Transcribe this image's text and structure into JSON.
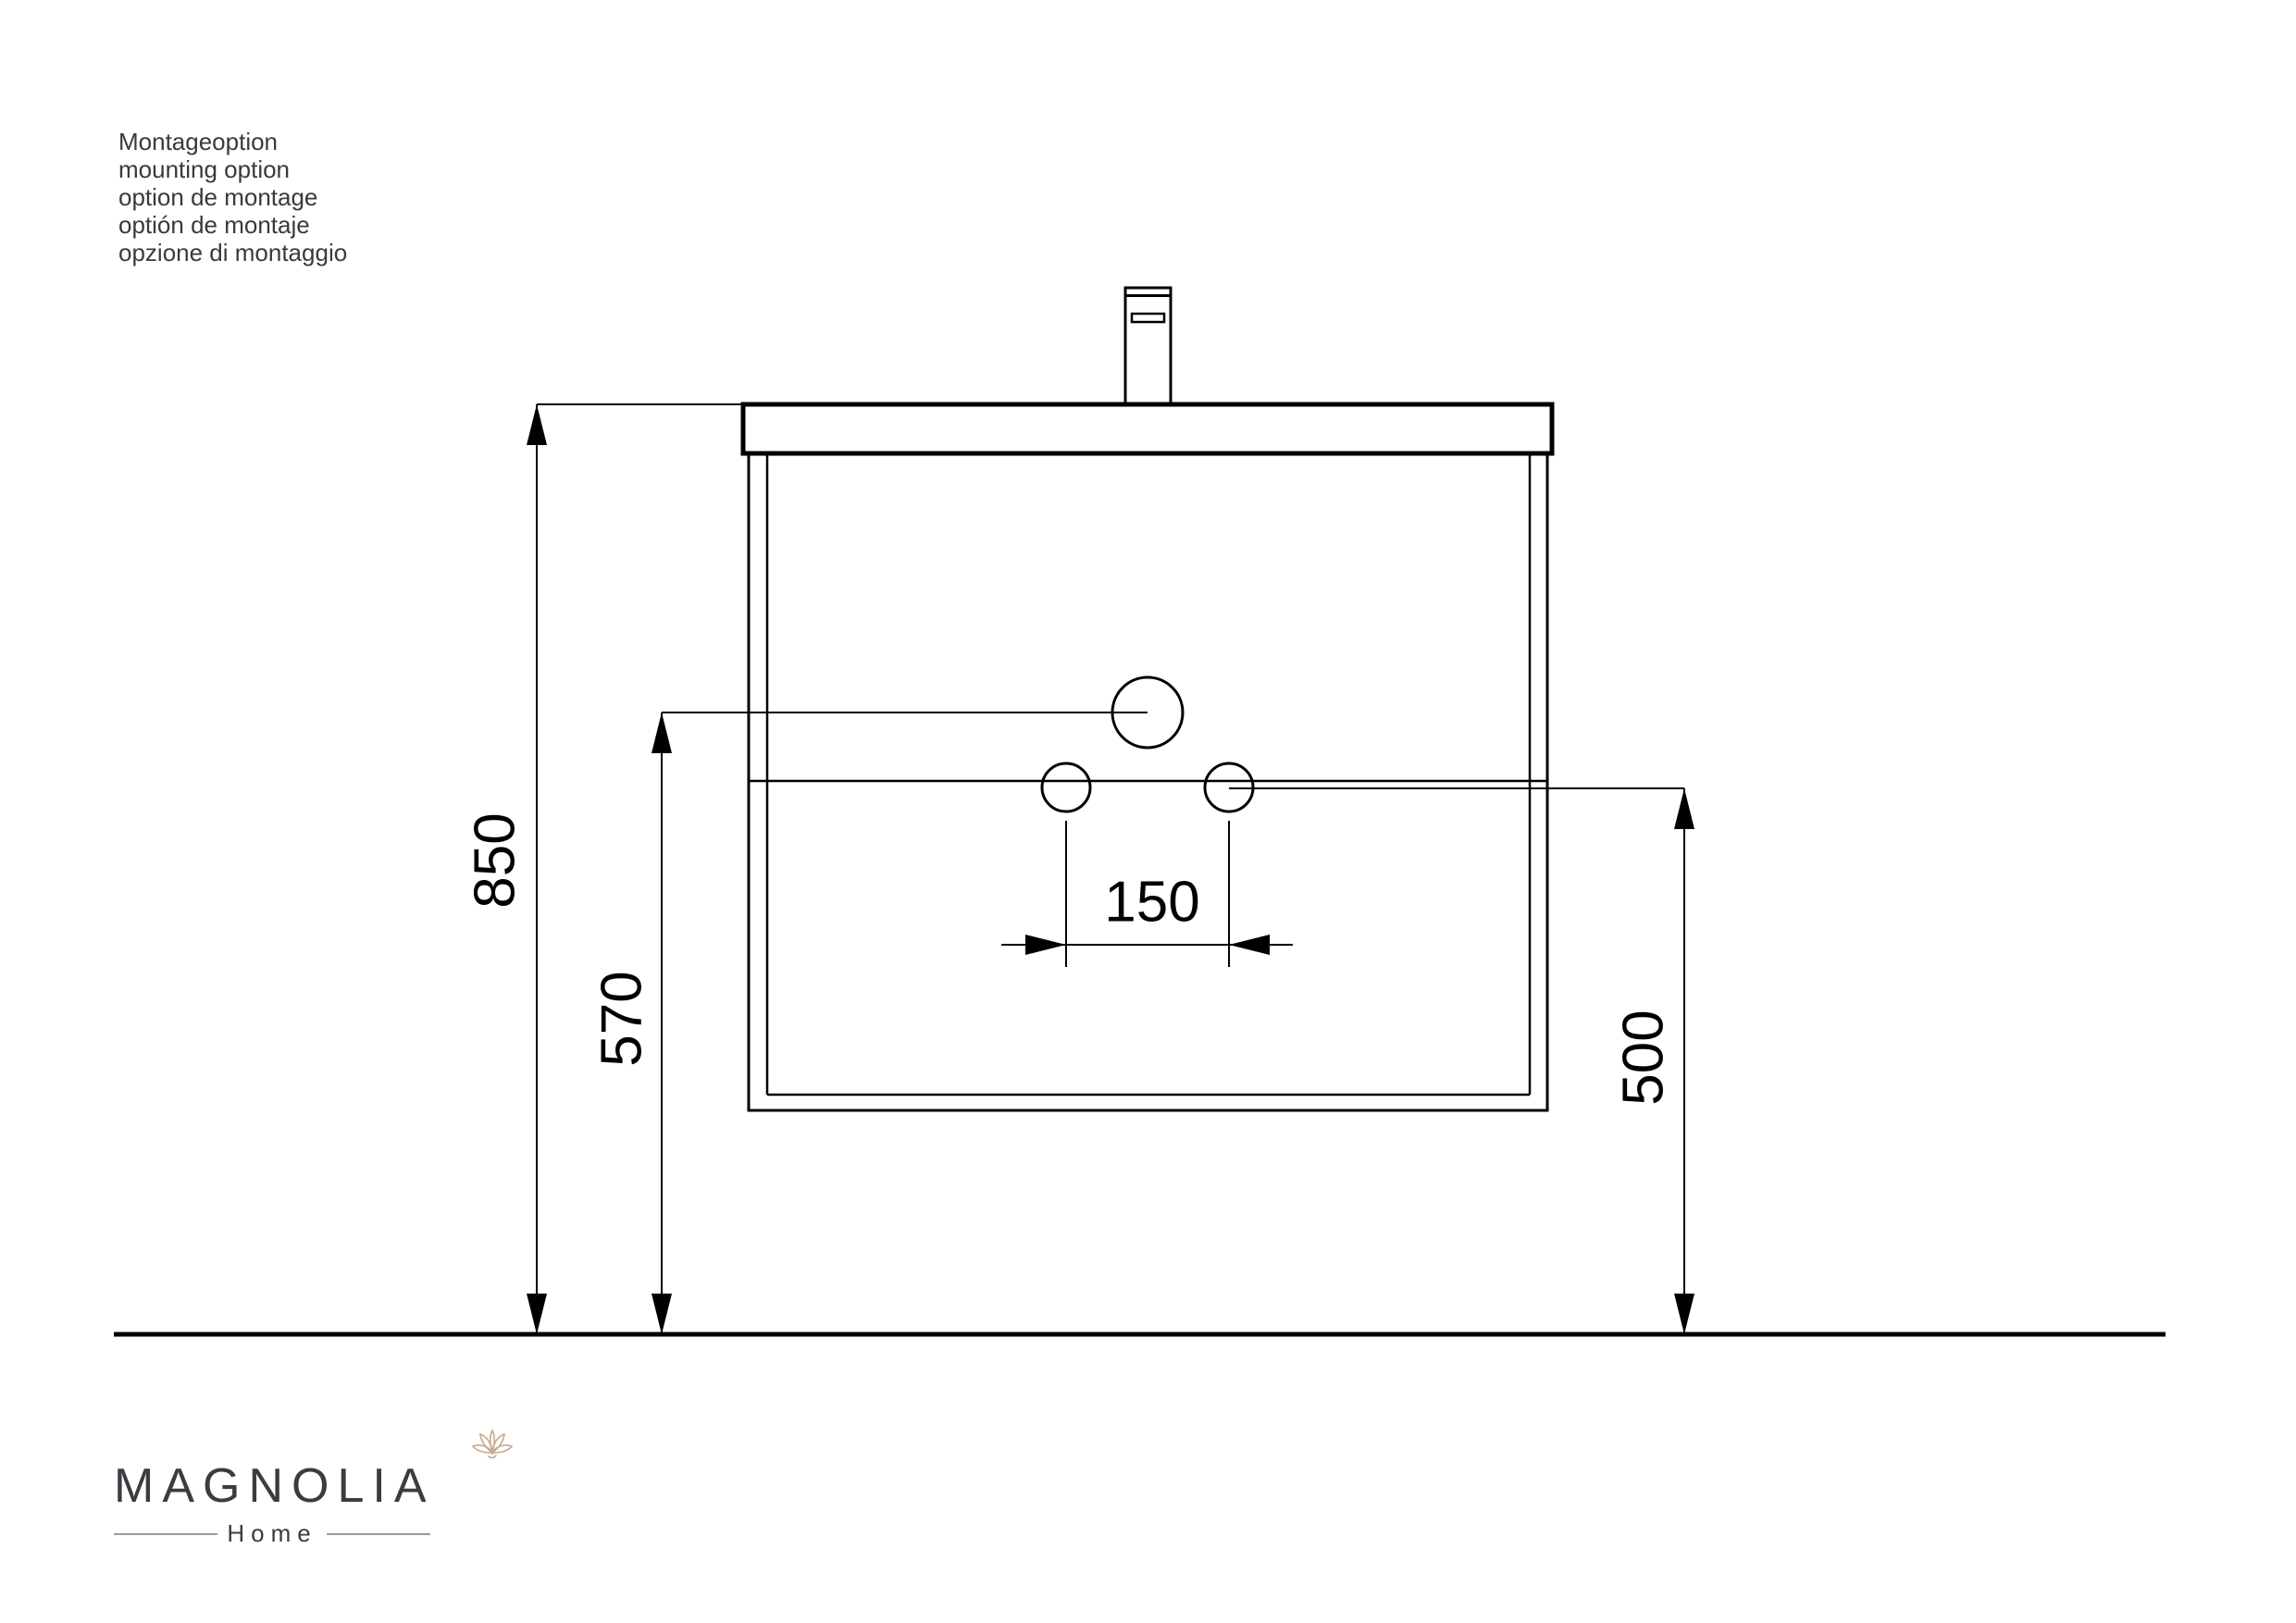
{
  "annotation": {
    "lines": [
      "Montageoption",
      "mounting option",
      "option de montage",
      "optión de montaje",
      "opzione di montaggio"
    ]
  },
  "dimensions": {
    "left_outer": "850",
    "left_inner": "570",
    "right": "500",
    "center_horizontal": "150"
  },
  "logo": {
    "brand": "MAGNOLIA",
    "tagline": "Home"
  },
  "colors": {
    "ink": "#000000",
    "annotation_text": "#3a3a3a",
    "logo_text": "#3b3b42",
    "logo_accent": "#c9a98c",
    "background": "#ffffff"
  }
}
